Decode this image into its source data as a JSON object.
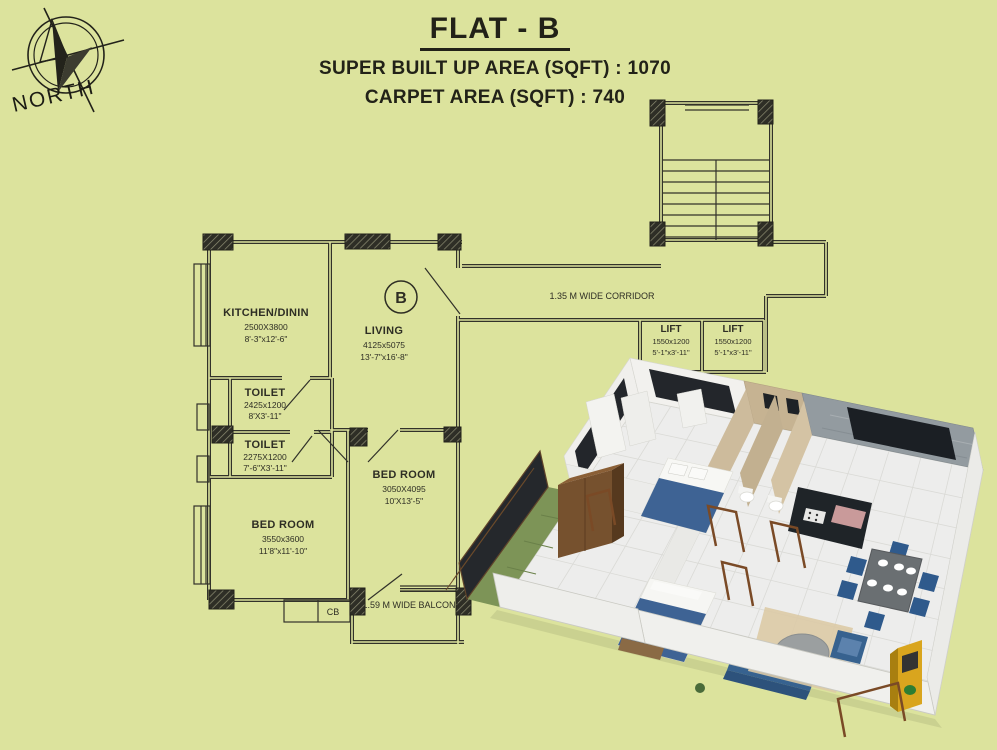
{
  "header": {
    "title": "FLAT - B",
    "super_built_up": "SUPER BUILT UP AREA (SQFT) : 1070",
    "carpet_area": "CARPET AREA (SQFT) : 740"
  },
  "compass": {
    "label": "NORTH"
  },
  "plan": {
    "kitchen": {
      "name": "KITCHEN/DININ",
      "dim1": "2500X3800",
      "dim2": "8'-3\"x12'-6\""
    },
    "living": {
      "name": "LIVING",
      "dim1": "4125x5075",
      "dim2": "13'-7\"x16'-8\"",
      "unit": "B"
    },
    "toilet1": {
      "name": "TOILET",
      "dim1": "2425x1200",
      "dim2": "8'X3'-11\""
    },
    "toilet2": {
      "name": "TOILET",
      "dim1": "2275X1200",
      "dim2": "7'-6\"X3'-11\""
    },
    "bedroom_right": {
      "name": "BED ROOM",
      "dim1": "3050X4095",
      "dim2": "10'X13'-5\""
    },
    "bedroom_left": {
      "name": "BED ROOM",
      "dim1": "3550x3600",
      "dim2": "11'8\"x11'-10\""
    },
    "lift1": {
      "name": "LIFT",
      "dim1": "1550x1200",
      "dim2": "5'-1\"x3'-11\""
    },
    "lift2": {
      "name": "LIFT",
      "dim1": "1550x1200",
      "dim2": "5'-1\"x3'-11\""
    },
    "corridor_label": "1.35 M WIDE CORRIDOR",
    "balcony_label": "1.59 M WIDE BALCONY",
    "cupboard_label": "CB"
  },
  "colors": {
    "background": "#dce39d",
    "plan_line": "#32322a",
    "render_blue": "#3e6394",
    "render_wood": "#76512e",
    "render_yellow": "#d9a51e"
  }
}
